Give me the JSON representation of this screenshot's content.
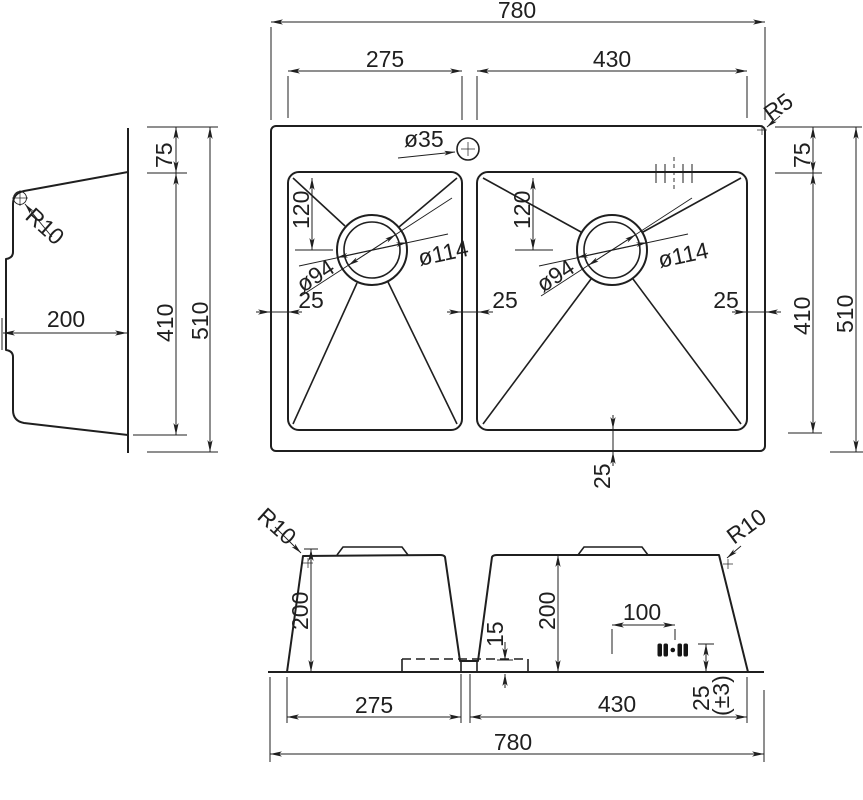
{
  "meta": {
    "drawing_type": "technical drawing — double bowl kitchen sink, three orthographic views",
    "background": "#ffffff",
    "line_color": "#1f1f1f"
  },
  "plan_view": {
    "overall_width": "780",
    "left_bowl_width": "275",
    "right_bowl_width": "430",
    "overall_depth": "510",
    "bowl_length": "410",
    "rim_margin_top": "75",
    "rim_margin": "25",
    "faucet_hole_dia": "ø35",
    "outer_corner_radius": "R5",
    "drain_offset_from_top": "120",
    "drain_inner_dia": "ø94",
    "drain_outer_dia": "ø114"
  },
  "side_view": {
    "bowl_depth": "200",
    "corner_radius": "R10",
    "rim_margin_top": "75",
    "bowl_length": "410",
    "overall_depth": "510"
  },
  "front_view": {
    "corner_radius": "R10",
    "bowl_depth": "200",
    "drain_offset": "100",
    "divider_depth": "15",
    "outlet_height": "25",
    "outlet_tolerance": "(±3)",
    "left_bowl_width": "275",
    "right_bowl_width": "430",
    "overall_width": "780"
  }
}
